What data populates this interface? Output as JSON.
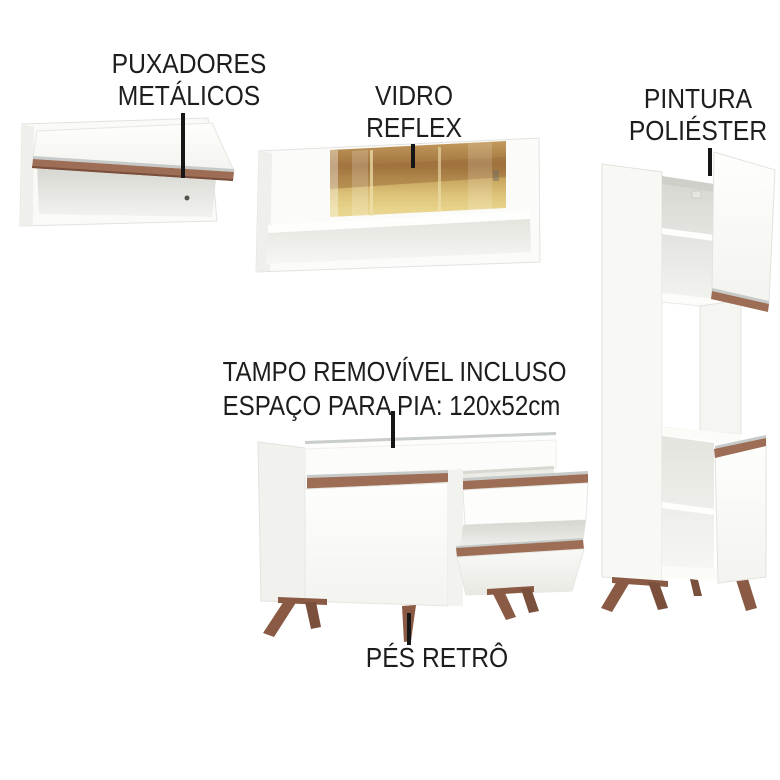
{
  "labels": {
    "handles": {
      "line1": "PUXADORES",
      "line2": "METÁLICOS"
    },
    "glass": {
      "line1": "VIDRO",
      "line2": "REFLEX"
    },
    "paint": {
      "line1": "PINTURA",
      "line2": "POLIÉSTER"
    },
    "countertop": {
      "line1": "TAMPO REMOVÍVEL INCLUSO",
      "line2": "ESPAÇO PARA PIA: 120x52cm"
    },
    "feet": {
      "line1": "PÉS RETRÔ"
    }
  },
  "colors": {
    "background": "#ffffff",
    "label_text": "#1d1d1b",
    "pointer_line": "#161616",
    "cabinet_white": "#fcfcfa",
    "cabinet_edge": "#e3e3df",
    "interior_shadow": "#d6d6d1",
    "wood_handle": "#9d6e55",
    "wood_handle_dark": "#7a4f3c",
    "wood_feet": "#8a5a44",
    "metal_edge": "#c6cac8",
    "glass_amber_light": "#ead890",
    "glass_amber_mid": "#c8a55e",
    "glass_amber_dark": "#a2743f"
  }
}
